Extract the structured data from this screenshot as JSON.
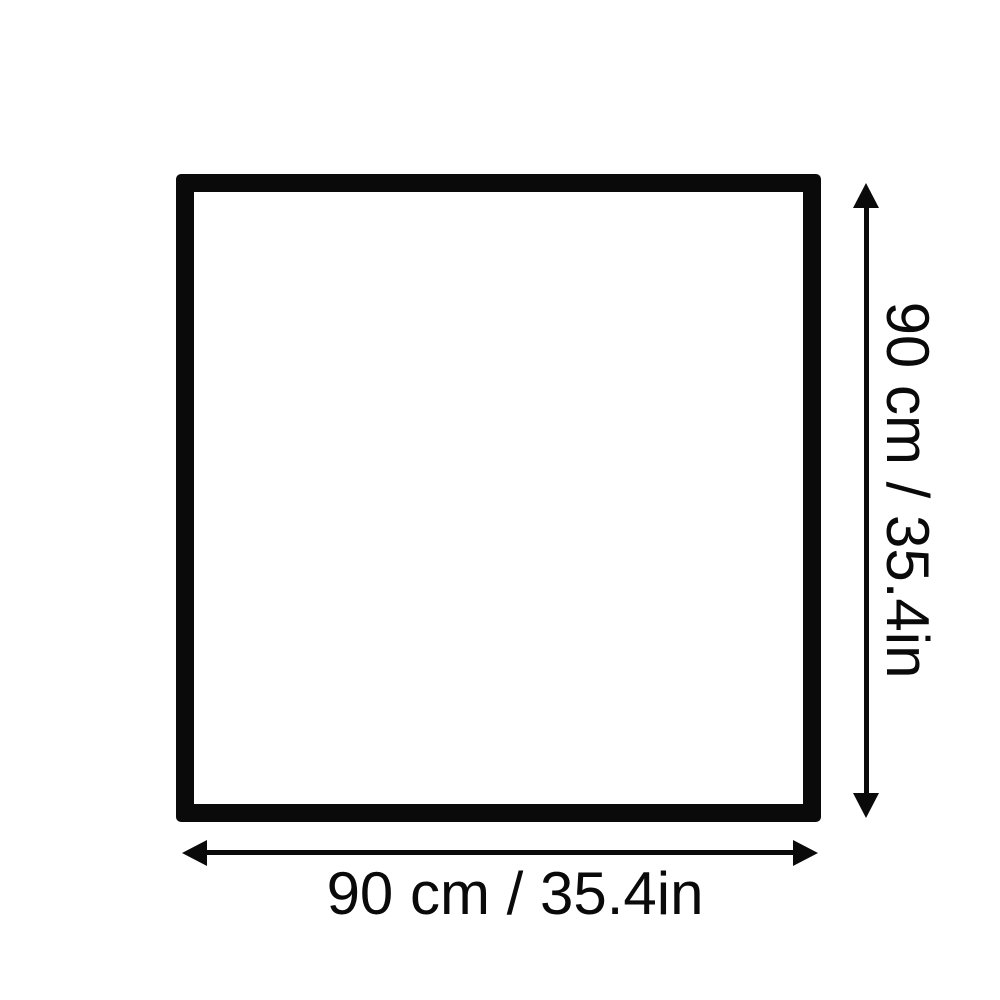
{
  "diagram": {
    "type": "product-dimension-diagram",
    "shape": "square",
    "colors": {
      "ink": "#0a0a0a",
      "background": "#ffffff"
    },
    "width_dimension": {
      "label": "90 cm / 35.4in",
      "cm": 90,
      "inches": 35.4
    },
    "height_dimension": {
      "label": "90 cm / 35.4in",
      "cm": 90,
      "inches": 35.4
    }
  }
}
